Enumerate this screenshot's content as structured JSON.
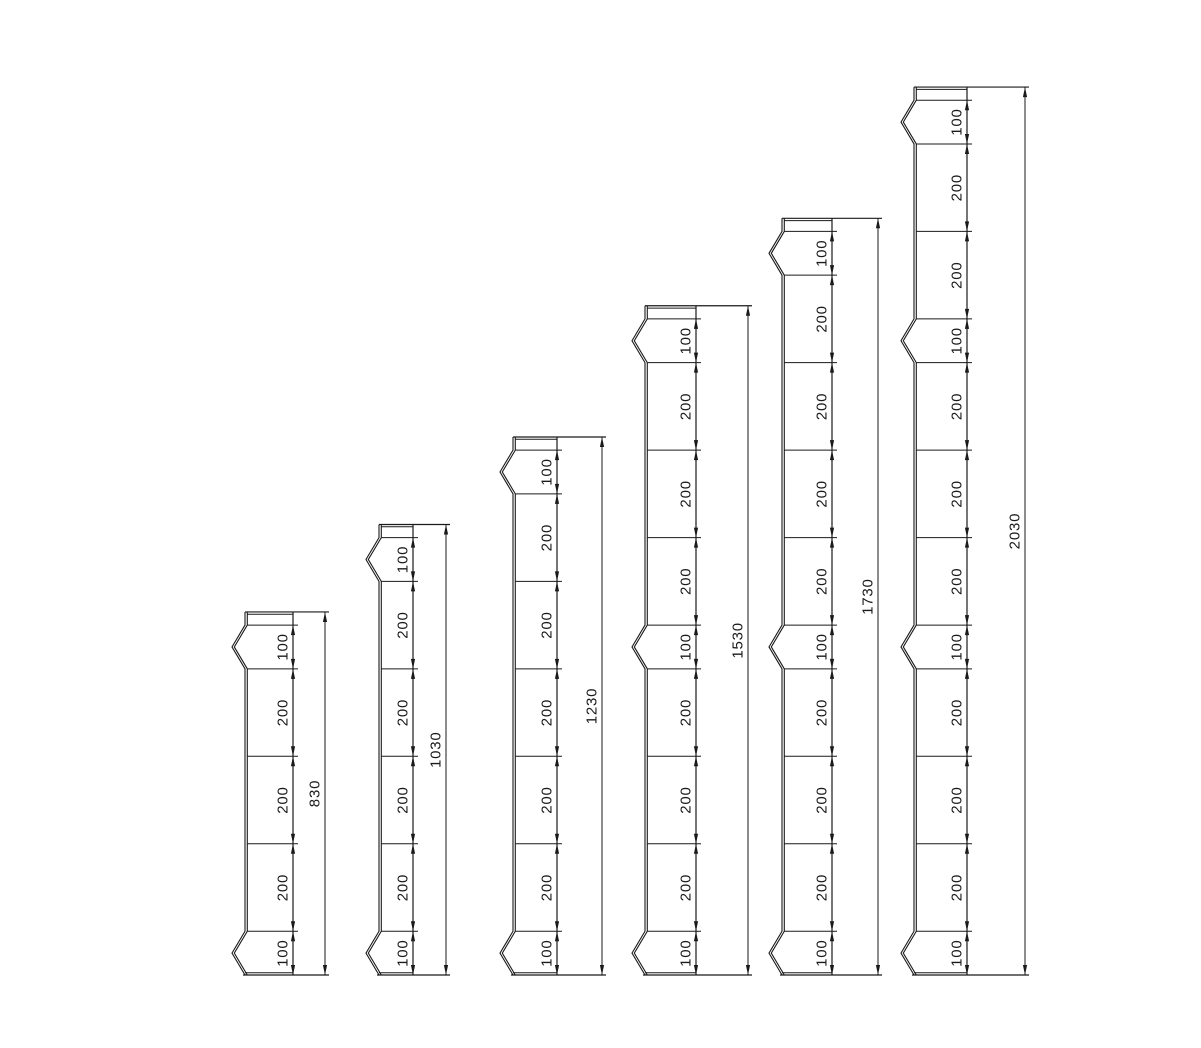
{
  "page": {
    "width": 1201,
    "height": 1048,
    "background": "#ffffff"
  },
  "drawing": {
    "name": "post-height-dimension-diagram",
    "line_color": "#1a1a1a",
    "text_color": "#1a1a1a",
    "font_size": 15,
    "letter_spacing": 0.8,
    "baseline_y": 975,
    "px_per_unit": 0.4374,
    "cap_units": 30,
    "notch_depth_px": 13,
    "double_line_gap_px": 2.3,
    "arrow_length_px": 10,
    "arrow_half_width_px": 2.1,
    "posts": [
      {
        "name": "post-830",
        "total_units": 830,
        "total_label": "830",
        "segments": [
          100,
          200,
          200,
          200,
          100
        ],
        "segment_labels": [
          "100",
          "200",
          "200",
          "200",
          "100"
        ],
        "notch_segments": [
          0,
          4
        ],
        "x_left": 245,
        "x_dim": 293,
        "x_overall": 325
      },
      {
        "name": "post-1030",
        "total_units": 1030,
        "total_label": "1030",
        "segments": [
          100,
          200,
          200,
          200,
          200,
          100
        ],
        "segment_labels": [
          "100",
          "200",
          "200",
          "200",
          "200",
          "100"
        ],
        "notch_segments": [
          0,
          5
        ],
        "x_left": 379,
        "x_dim": 413,
        "x_overall": 446
      },
      {
        "name": "post-1230",
        "total_units": 1230,
        "total_label": "1230",
        "segments": [
          100,
          200,
          200,
          200,
          200,
          200,
          100
        ],
        "segment_labels": [
          "100",
          "200",
          "200",
          "200",
          "200",
          "200",
          "100"
        ],
        "notch_segments": [
          0,
          6
        ],
        "x_left": 513,
        "x_dim": 557,
        "x_overall": 602
      },
      {
        "name": "post-1530",
        "total_units": 1530,
        "total_label": "1530",
        "segments": [
          100,
          200,
          200,
          200,
          100,
          200,
          200,
          200,
          100
        ],
        "segment_labels": [
          "100",
          "200",
          "200",
          "200",
          "100",
          "200",
          "200",
          "200",
          "100"
        ],
        "notch_segments": [
          0,
          4,
          8
        ],
        "x_left": 645,
        "x_dim": 696,
        "x_overall": 748
      },
      {
        "name": "post-1730",
        "total_units": 1730,
        "total_label": "1730",
        "segments": [
          100,
          200,
          200,
          200,
          200,
          100,
          200,
          200,
          200,
          100
        ],
        "segment_labels": [
          "100",
          "200",
          "200",
          "200",
          "200",
          "100",
          "200",
          "200",
          "200",
          "100"
        ],
        "notch_segments": [
          0,
          5,
          9
        ],
        "x_left": 782,
        "x_dim": 832,
        "x_overall": 878
      },
      {
        "name": "post-2030",
        "total_units": 2030,
        "total_label": "2030",
        "segments": [
          100,
          200,
          200,
          100,
          200,
          200,
          200,
          100,
          200,
          200,
          200,
          100
        ],
        "segment_labels": [
          "100",
          "200",
          "200",
          "100",
          "200",
          "200",
          "200",
          "100",
          "200",
          "200",
          "200",
          "100"
        ],
        "notch_segments": [
          0,
          3,
          7,
          11
        ],
        "x_left": 914,
        "x_dim": 967,
        "x_overall": 1025
      }
    ]
  }
}
